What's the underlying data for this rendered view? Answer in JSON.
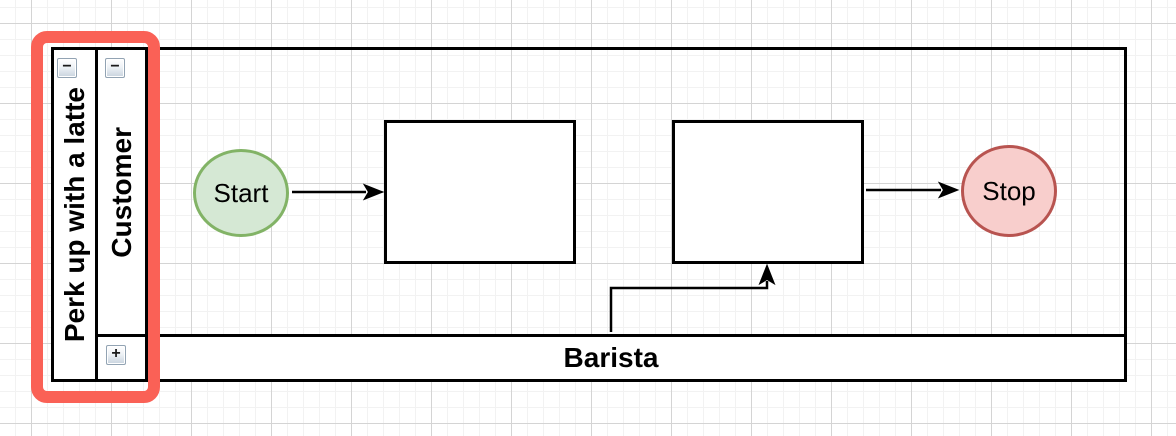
{
  "pool": {
    "title": "Perk up with a latte",
    "collapse_button": "−"
  },
  "lanes": {
    "customer": {
      "title": "Customer",
      "collapse_button": "−",
      "state": "expanded"
    },
    "barista": {
      "title": "Barista",
      "expand_button": "+",
      "state": "collapsed"
    }
  },
  "nodes": {
    "start": {
      "label": "Start",
      "shape": "ellipse",
      "fill": "#d5e8d4",
      "stroke": "#82b366"
    },
    "task1": {
      "label": "",
      "shape": "rectangle",
      "fill": "#ffffff",
      "stroke": "#000000"
    },
    "task2": {
      "label": "",
      "shape": "rectangle",
      "fill": "#ffffff",
      "stroke": "#000000"
    },
    "stop": {
      "label": "Stop",
      "shape": "ellipse",
      "fill": "#f8cecc",
      "stroke": "#b85450"
    }
  },
  "edges": [
    {
      "from": "start",
      "to": "task1",
      "style": "straight-arrow"
    },
    {
      "from": "barista-lane",
      "to": "task2",
      "style": "elbow-arrow"
    },
    {
      "from": "task2",
      "to": "stop",
      "style": "straight-arrow"
    }
  ],
  "annotation": {
    "type": "highlight-box",
    "color": "#fa6156",
    "around": "pool and lane title headers"
  },
  "colors": {
    "edge": "#000000",
    "lane_border": "#000000",
    "grid_minor": "#f2f2f2",
    "grid_major": "#d4d4d4"
  }
}
